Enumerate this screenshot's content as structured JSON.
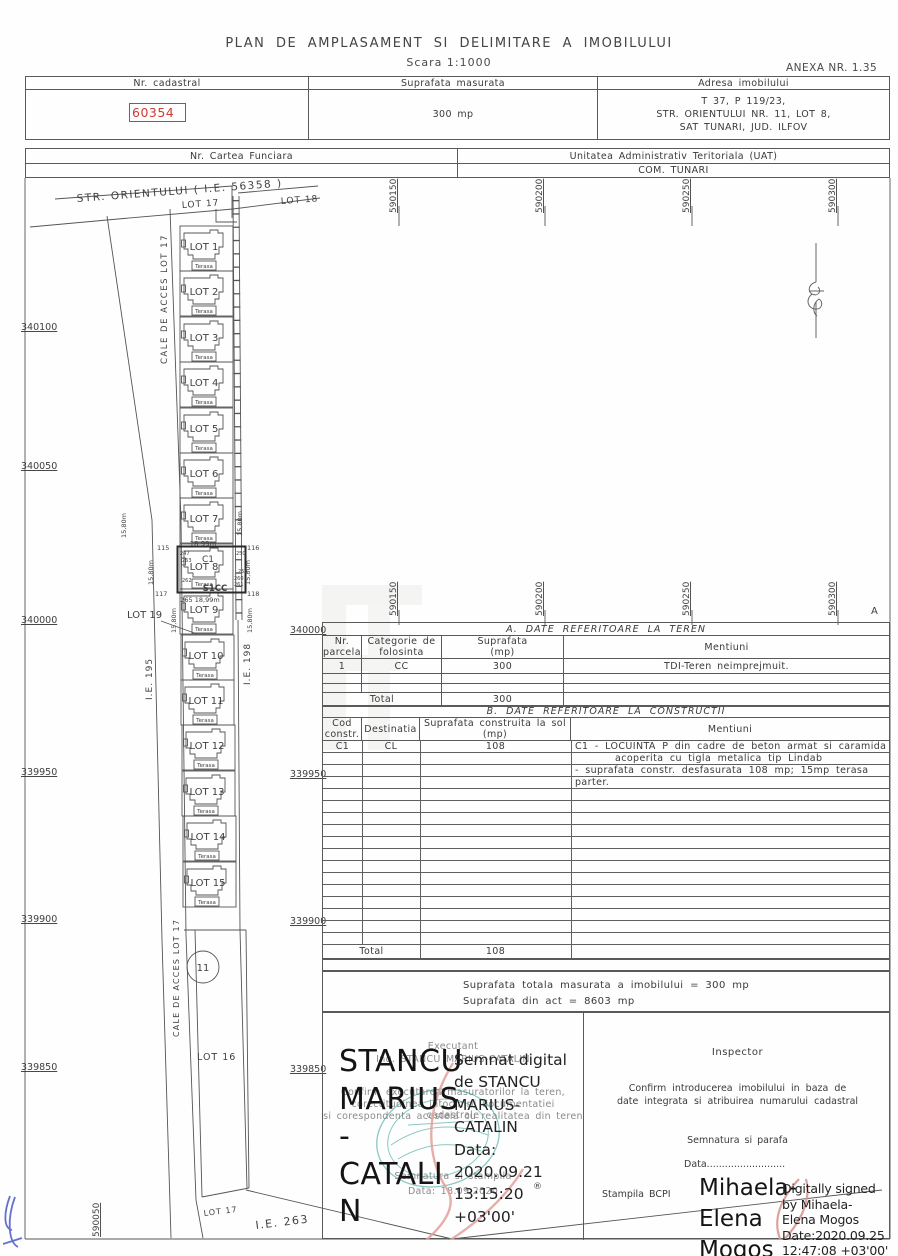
{
  "page": {
    "title": "PLAN  DE  AMPLASAMENT  SI  DELIMITARE  A  IMOBILULUI",
    "scale": "Scara  1:1000",
    "anexa": "ANEXA  NR.  1.35"
  },
  "header_table": {
    "col1": "Nr. cadastral",
    "col2": "Suprafata masurata",
    "col3": "Adresa imobilului",
    "nr_cadastral": "60354",
    "suprafata": "300 mp",
    "adresa1": "T 37, P 119/23,",
    "adresa2": "STR. ORIENTULUI NR. 11, LOT 8,",
    "adresa3": "SAT TUNARI, JUD. ILFOV"
  },
  "cf_table": {
    "col1": "Nr. Cartea Funciara",
    "col2": "Unitatea Administrativ Teritoriala (UAT)",
    "uat": "COM. TUNARI"
  },
  "map": {
    "street": "STR.  ORIENTULUI  (  I.E.  56358  )",
    "lot17_top": "LOT 17",
    "lot18": "LOT 18",
    "cale_acces": "CALE  DE  ACCES    LOT 17",
    "terasa": "Terasa",
    "lots": [
      {
        "label": "LOT 1"
      },
      {
        "label": "LOT 2"
      },
      {
        "label": "LOT 3"
      },
      {
        "label": "LOT 4"
      },
      {
        "label": "LOT 5"
      },
      {
        "label": "LOT 6"
      },
      {
        "label": "LOT 7"
      },
      {
        "label": "LOT 8"
      },
      {
        "label": "LOT 9"
      },
      {
        "label": "LOT 10"
      },
      {
        "label": "LOT 11"
      },
      {
        "label": "LOT 12"
      },
      {
        "label": "LOT 13"
      },
      {
        "label": "LOT 14"
      },
      {
        "label": "LOT 15"
      }
    ],
    "lot8": {
      "c1": "C1",
      "s1cc": "S1CC",
      "len_top": "18,99m",
      "len_bottom": "265  18,99m",
      "p115": "115",
      "p116": "116",
      "p117": "117",
      "p118": "118",
      "p247": "247",
      "p250": "250",
      "p263": "263",
      "p258": "258",
      "p260": "260",
      "p261": "261",
      "p262": "262"
    },
    "measures": [
      "15,80m",
      "15,80m",
      "15,80m",
      "15,80m",
      "15,80m",
      "15,80m"
    ],
    "lot19": "LOT 19",
    "lot16": "LOT 16",
    "lot17_bottom": "LOT 17",
    "ie195": "I.E.  195",
    "ie198": "I.E.  198",
    "ie263": "I.E.  263",
    "circle11": "11",
    "coords_left": [
      "340100",
      "340050",
      "340000",
      "339950",
      "339900",
      "339850"
    ],
    "coords_right": [
      "340000",
      "339950",
      "339900",
      "339850"
    ],
    "grid_top": [
      "590150",
      "590200",
      "590250",
      "590300"
    ],
    "grid_mid": [
      "590150",
      "590200",
      "590250",
      "590300"
    ],
    "grid_bottom": "590050",
    "corner_a": "A"
  },
  "table_a": {
    "title": "A.  DATE  REFERITOARE  LA  TEREN",
    "h_nr": "Nr.\nparcela",
    "h_cat": "Categorie de\nfolosinta",
    "h_sup": "Suprafata\n(mp)",
    "h_men": "Mentiuni",
    "r_nr": "1",
    "r_cat": "CC",
    "r_sup": "300",
    "r_men": "TDI-Teren  neimprejmuit.",
    "total_label": "Total",
    "total_value": "300"
  },
  "table_b": {
    "title": "B.  DATE  REFERITOARE  LA  CONSTRUCTII",
    "h_cod": "Cod\nconstr.",
    "h_dest": "Destinatia",
    "h_sup": "Suprafata construita la sol\n(mp)",
    "h_men": "Mentiuni",
    "r_cod": "C1",
    "r_dest": "CL",
    "r_sup": "108",
    "men1": "C1 - LOCUINTA P din cadre de beton armat si caramida",
    "men2": "acoperita cu tigla metalica tip Lindab",
    "men3": "- suprafata constr. desfasurata 108 mp; 15mp terasa parter.",
    "total_label": "Total",
    "total_value": "108"
  },
  "totals": {
    "line1": "Suprafata totala masurata a imobilului = 300 mp",
    "line2": "Suprafata din act = 8603 mp"
  },
  "executant": {
    "faint_title": "Executant",
    "faint_name": "Ing. STANCU MARIUS-CATALIN",
    "confirm1": "Confirm executarea masuratorilor la teren,",
    "confirm2": "corectitudinea intocmirii documentatiei cadastrale",
    "confirm3": "si corespondenta acesteia cu realitatea din teren",
    "semnatura": "Semnatura si stampila",
    "data": "Data: 18.09.2020",
    "sig_name": "STANCU\nMARIUS\n-\nCATALI\nN",
    "sig_details": "Semnat digital\nde STANCU\nMARIUS-\nCATALIN\nData:\n2020.09.21\n13:15:20\n+03'00'",
    "reg_mark": "®"
  },
  "inspector": {
    "title": "Inspector",
    "confirm1": "Confirm introducerea imobilului in baza de",
    "confirm2": "date integrata si atribuirea numarului cadastral",
    "semnatura": "Semnatura si parafa",
    "data_line": "Data..........................",
    "stampila": "Stampila BCPI",
    "sig_name": "Mihaela-\nElena\nMogos",
    "sig_details": "Digitally signed\nby Mihaela-\nElena Mogos\nDate:2020.09.25\n12:47:08 +03'00'"
  },
  "colors": {
    "cadastral_red": "#d03a34",
    "stamp_teal": "#2f9d93",
    "ribbon_pink": "#e2a19b",
    "pen_blue": "#4a58c8"
  }
}
